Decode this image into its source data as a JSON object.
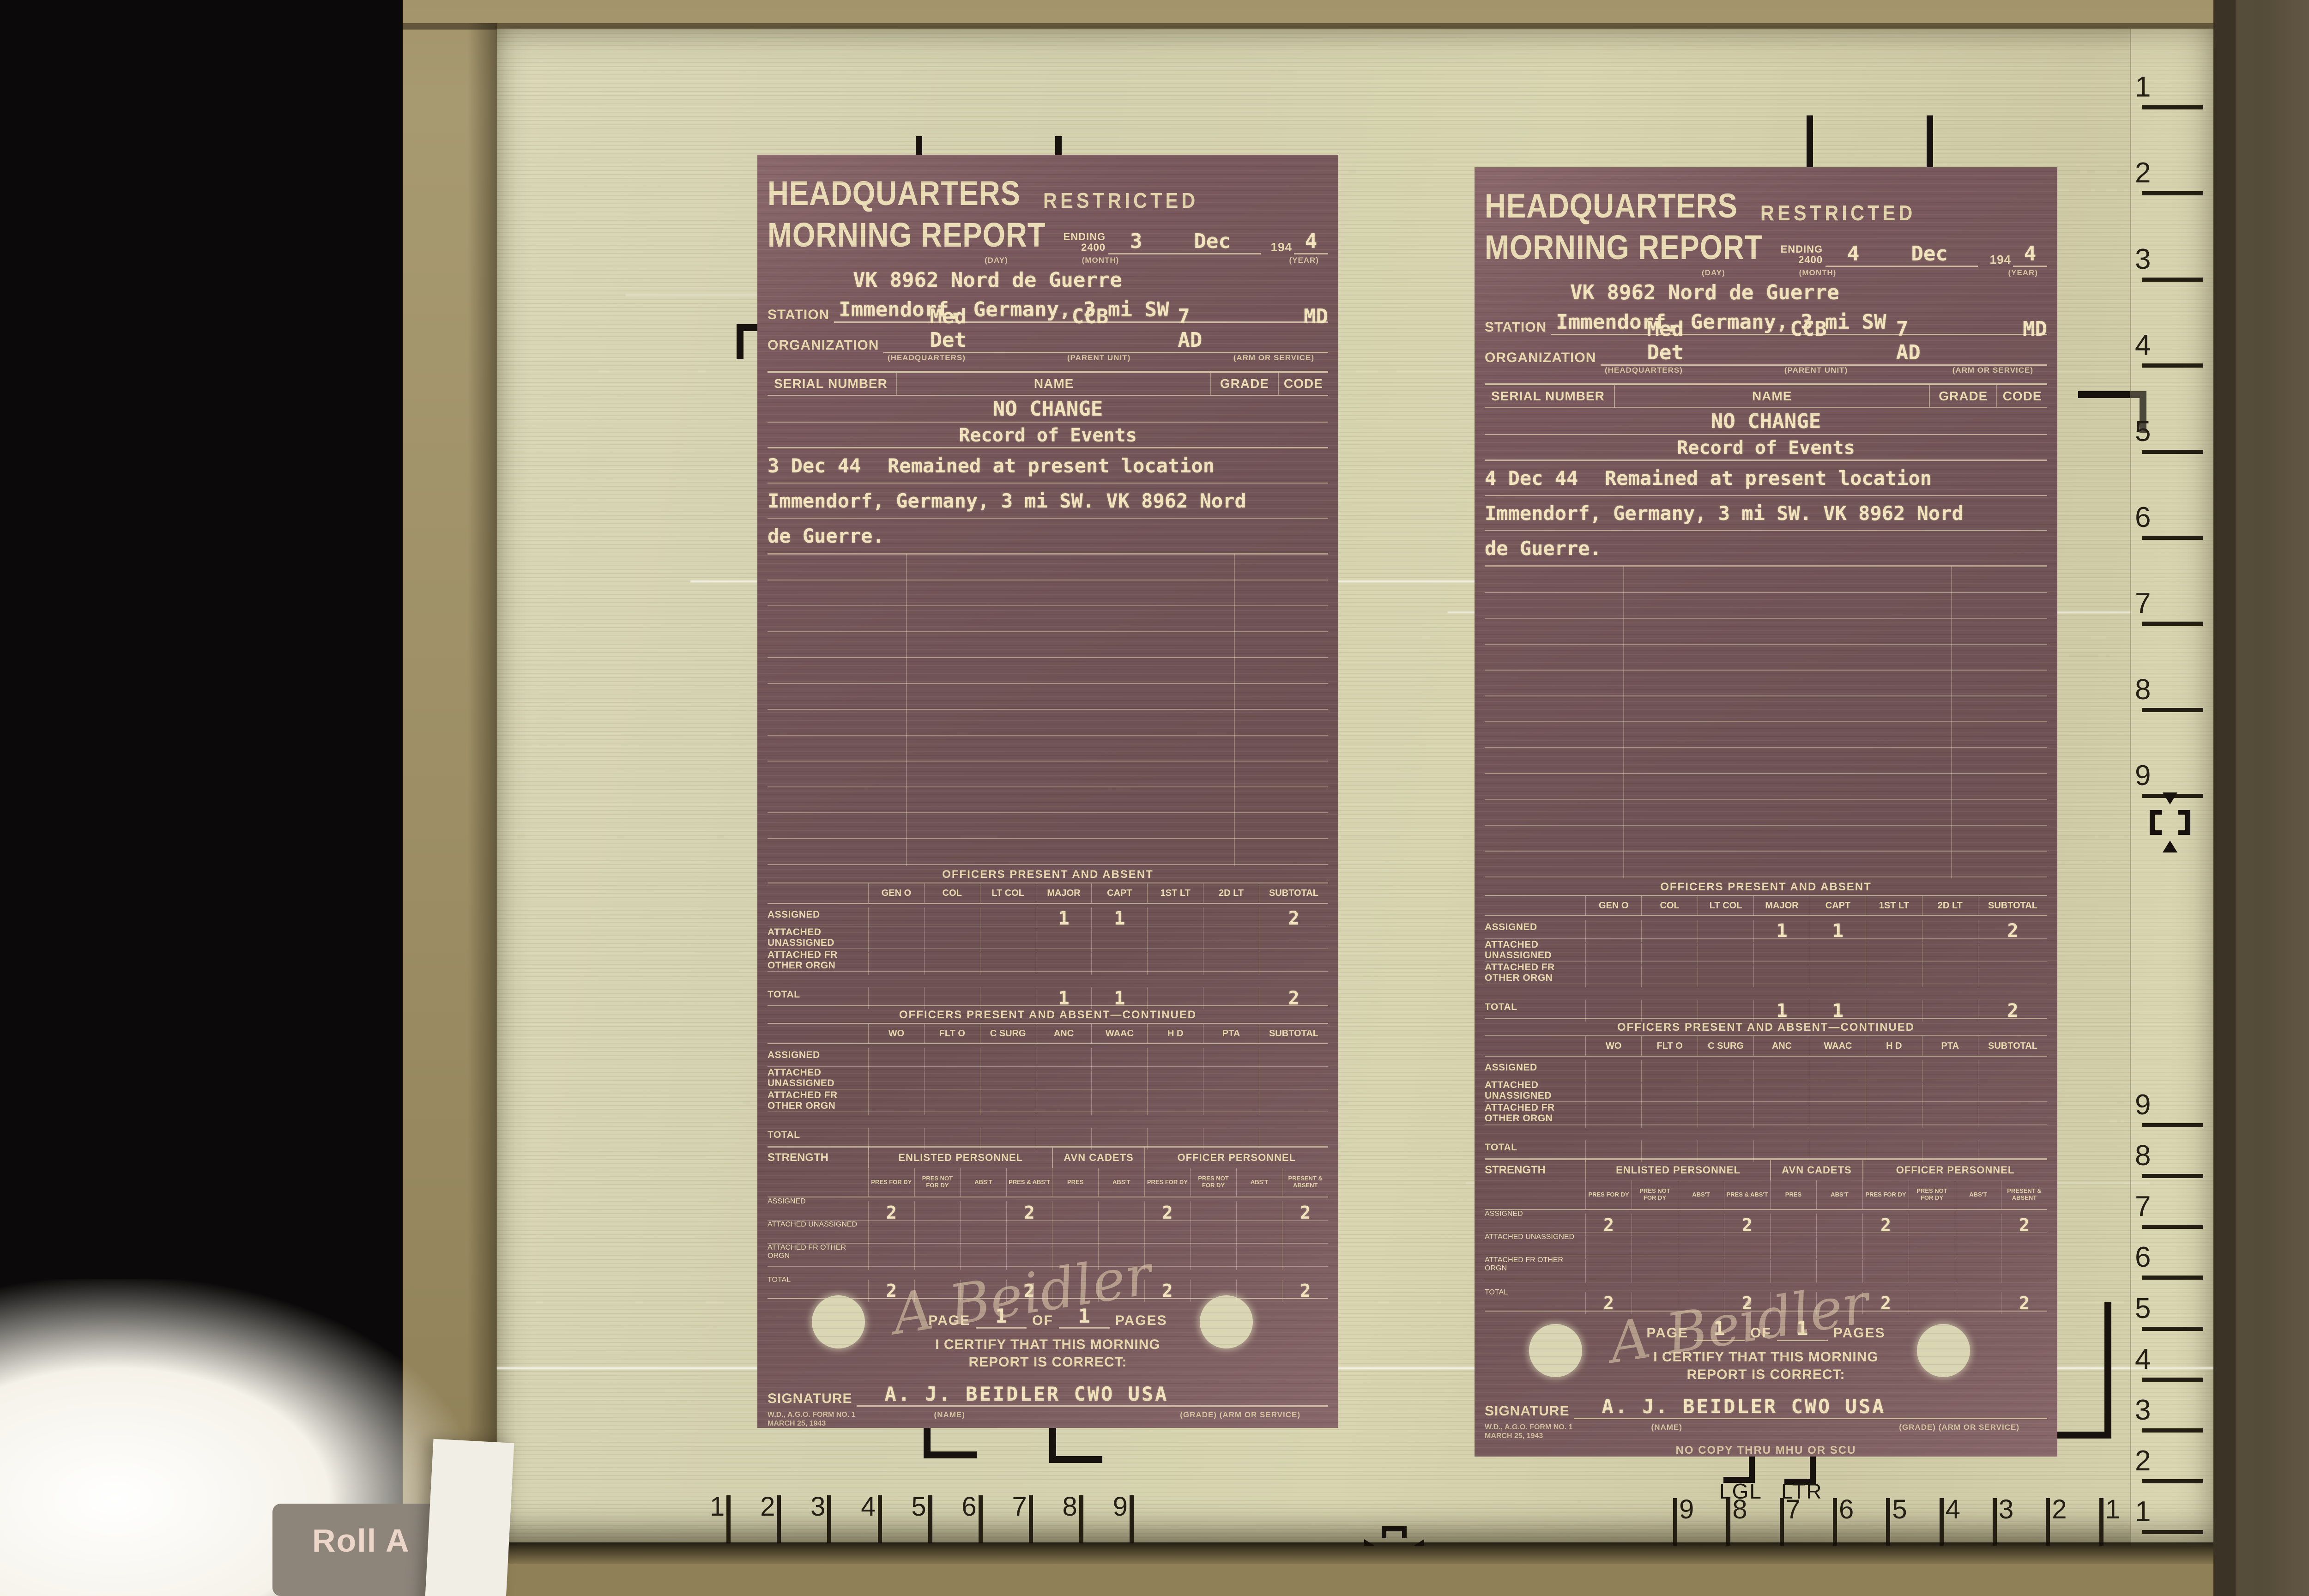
{
  "machine": {
    "roll_label": "Roll A",
    "lgl_label": "LGL",
    "ltr_label": "LTR"
  },
  "rulers": {
    "right_top": [
      "1",
      "2",
      "3",
      "4",
      "5",
      "6",
      "7",
      "8",
      "9"
    ],
    "right_bottom": [
      "9",
      "8",
      "7",
      "6",
      "5",
      "4",
      "3",
      "2",
      "1"
    ],
    "bottom_left": [
      "1",
      "2",
      "3",
      "4",
      "5",
      "6",
      "7",
      "8",
      "9"
    ],
    "bottom_right": [
      "9",
      "8",
      "7",
      "6",
      "5",
      "4",
      "3",
      "2",
      "1"
    ]
  },
  "documents": [
    {
      "header_line1": "HEADQUARTERS",
      "classification": "RESTRICTED",
      "header_line2": "MORNING REPORT",
      "ending_label_1": "ENDING",
      "ending_label_2": "2400",
      "day": "3",
      "month": "Dec",
      "year_prefix": "194",
      "year_digit": "4",
      "day_label": "(DAY)",
      "month_label": "(MONTH)",
      "year_label": "(YEAR)",
      "code_line": "VK 8962 Nord de Guerre",
      "station_label": "STATION",
      "station_value": "Immendorf, Germany, 3 mi SW",
      "organization_label": "ORGANIZATION",
      "org_headquarters": "Med Det",
      "org_parent1": "CCB",
      "org_parent2": "7 AD",
      "org_arm": "MD",
      "org_sub_headquarters": "(HEADQUARTERS)",
      "org_sub_parent": "(PARENT UNIT)",
      "org_sub_arm": "(ARM OR SERVICE)",
      "roster_headers": [
        "SERIAL NUMBER",
        "NAME",
        "GRADE",
        "CODE"
      ],
      "no_change": "NO CHANGE",
      "events_title": "Record of Events",
      "event_date": "3 Dec 44",
      "event_line1": "Remained at present location",
      "event_line2": "Immendorf, Germany, 3 mi SW. VK 8962 Nord",
      "event_line3": "de Guerre.",
      "officers": {
        "title": "OFFICERS PRESENT AND ABSENT",
        "columns": [
          "GEN O",
          "COL",
          "LT COL",
          "MAJOR",
          "CAPT",
          "1ST LT",
          "2D LT",
          "SUBTOTAL"
        ],
        "rows": [
          {
            "label": "ASSIGNED",
            "values": [
              "",
              "",
              "",
              "1",
              "1",
              "",
              "",
              "2"
            ]
          },
          {
            "label": "ATTACHED UNASSIGNED",
            "values": [
              "",
              "",
              "",
              "",
              "",
              "",
              "",
              ""
            ]
          },
          {
            "label": "ATTACHED FR OTHER ORGN",
            "values": [
              "",
              "",
              "",
              "",
              "",
              "",
              "",
              ""
            ]
          },
          {
            "label": "TOTAL",
            "values": [
              "",
              "",
              "",
              "1",
              "1",
              "",
              "",
              "2"
            ]
          }
        ]
      },
      "officers_continued": {
        "title": "OFFICERS PRESENT AND ABSENT—CONTINUED",
        "columns": [
          "WO",
          "FLT O",
          "C SURG",
          "ANC",
          "WAAC",
          "H D",
          "PTA",
          "SUBTOTAL"
        ],
        "rows": [
          {
            "label": "ASSIGNED",
            "values": [
              "",
              "",
              "",
              "",
              "",
              "",
              "",
              ""
            ]
          },
          {
            "label": "ATTACHED UNASSIGNED",
            "values": [
              "",
              "",
              "",
              "",
              "",
              "",
              "",
              ""
            ]
          },
          {
            "label": "ATTACHED FR OTHER ORGN",
            "values": [
              "",
              "",
              "",
              "",
              "",
              "",
              "",
              ""
            ]
          },
          {
            "label": "TOTAL",
            "values": [
              "",
              "",
              "",
              "",
              "",
              "",
              "",
              ""
            ]
          }
        ]
      },
      "strength": {
        "label": "STRENGTH",
        "group_headers": [
          "ENLISTED PERSONNEL",
          "AVN CADETS",
          "OFFICER PERSONNEL"
        ],
        "columns": [
          "PRES FOR DY",
          "PRES NOT FOR DY",
          "ABS'T",
          "PRES & ABS'T",
          "PRES",
          "ABS'T",
          "PRES FOR DY",
          "PRES NOT FOR DY",
          "ABS'T",
          "PRESENT & ABSENT"
        ],
        "rows": [
          {
            "label": "ASSIGNED",
            "values": [
              "2",
              "",
              "",
              "2",
              "",
              "",
              "2",
              "",
              "",
              "2"
            ]
          },
          {
            "label": "ATTACHED UNASSIGNED",
            "values": [
              "",
              "",
              "",
              "",
              "",
              "",
              "",
              "",
              "",
              ""
            ]
          },
          {
            "label": "ATTACHED FR OTHER ORGN",
            "values": [
              "",
              "",
              "",
              "",
              "",
              "",
              "",
              "",
              "",
              ""
            ]
          },
          {
            "label": "TOTAL",
            "values": [
              "2",
              "",
              "",
              "2",
              "",
              "",
              "2",
              "",
              "",
              "2"
            ]
          }
        ]
      },
      "page_label_1": "PAGE",
      "page_num": "1",
      "page_label_2": "OF",
      "page_total": "1",
      "page_label_3": "PAGES",
      "certify_line1": "I CERTIFY THAT THIS MORNING",
      "certify_line2": "REPORT IS CORRECT:",
      "signature_label": "SIGNATURE",
      "signature_text": "A. J. BEIDLER  CWO  USA",
      "signature_script": "A Beidler",
      "form_id_line1": "W.D., A.G.O. FORM NO. 1",
      "form_id_line2": "MARCH 25, 1943",
      "name_sublabel": "(NAME)",
      "grade_sublabel": "(GRADE)  (ARM OR SERVICE)",
      "copy_note": "NO COPY THRU MHU OR SCU"
    },
    {
      "header_line1": "HEADQUARTERS",
      "classification": "RESTRICTED",
      "header_line2": "MORNING REPORT",
      "ending_label_1": "ENDING",
      "ending_label_2": "2400",
      "day": "4",
      "month": "Dec",
      "year_prefix": "194",
      "year_digit": "4",
      "day_label": "(DAY)",
      "month_label": "(MONTH)",
      "year_label": "(YEAR)",
      "code_line": "VK 8962 Nord de Guerre",
      "station_label": "STATION",
      "station_value": "Immendorf, Germany, 3 mi SW",
      "organization_label": "ORGANIZATION",
      "org_headquarters": "Med Det",
      "org_parent1": "CCB",
      "org_parent2": "7 AD",
      "org_arm": "MD",
      "org_sub_headquarters": "(HEADQUARTERS)",
      "org_sub_parent": "(PARENT UNIT)",
      "org_sub_arm": "(ARM OR SERVICE)",
      "roster_headers": [
        "SERIAL NUMBER",
        "NAME",
        "GRADE",
        "CODE"
      ],
      "no_change": "NO CHANGE",
      "events_title": "Record of Events",
      "event_date": "4 Dec 44",
      "event_line1": "Remained at present location",
      "event_line2": "Immendorf, Germany, 3 mi SW. VK 8962 Nord",
      "event_line3": "de Guerre.",
      "officers": {
        "title": "OFFICERS PRESENT AND ABSENT",
        "columns": [
          "GEN O",
          "COL",
          "LT COL",
          "MAJOR",
          "CAPT",
          "1ST LT",
          "2D LT",
          "SUBTOTAL"
        ],
        "rows": [
          {
            "label": "ASSIGNED",
            "values": [
              "",
              "",
              "",
              "1",
              "1",
              "",
              "",
              "2"
            ]
          },
          {
            "label": "ATTACHED UNASSIGNED",
            "values": [
              "",
              "",
              "",
              "",
              "",
              "",
              "",
              ""
            ]
          },
          {
            "label": "ATTACHED FR OTHER ORGN",
            "values": [
              "",
              "",
              "",
              "",
              "",
              "",
              "",
              ""
            ]
          },
          {
            "label": "TOTAL",
            "values": [
              "",
              "",
              "",
              "1",
              "1",
              "",
              "",
              "2"
            ]
          }
        ]
      },
      "officers_continued": {
        "title": "OFFICERS PRESENT AND ABSENT—CONTINUED",
        "columns": [
          "WO",
          "FLT O",
          "C SURG",
          "ANC",
          "WAAC",
          "H D",
          "PTA",
          "SUBTOTAL"
        ],
        "rows": [
          {
            "label": "ASSIGNED",
            "values": [
              "",
              "",
              "",
              "",
              "",
              "",
              "",
              ""
            ]
          },
          {
            "label": "ATTACHED UNASSIGNED",
            "values": [
              "",
              "",
              "",
              "",
              "",
              "",
              "",
              ""
            ]
          },
          {
            "label": "ATTACHED FR OTHER ORGN",
            "values": [
              "",
              "",
              "",
              "",
              "",
              "",
              "",
              ""
            ]
          },
          {
            "label": "TOTAL",
            "values": [
              "",
              "",
              "",
              "",
              "",
              "",
              "",
              ""
            ]
          }
        ]
      },
      "strength": {
        "label": "STRENGTH",
        "group_headers": [
          "ENLISTED PERSONNEL",
          "AVN CADETS",
          "OFFICER PERSONNEL"
        ],
        "columns": [
          "PRES FOR DY",
          "PRES NOT FOR DY",
          "ABS'T",
          "PRES & ABS'T",
          "PRES",
          "ABS'T",
          "PRES FOR DY",
          "PRES NOT FOR DY",
          "ABS'T",
          "PRESENT & ABSENT"
        ],
        "rows": [
          {
            "label": "ASSIGNED",
            "values": [
              "2",
              "",
              "",
              "2",
              "",
              "",
              "2",
              "",
              "",
              "2"
            ]
          },
          {
            "label": "ATTACHED UNASSIGNED",
            "values": [
              "",
              "",
              "",
              "",
              "",
              "",
              "",
              "",
              "",
              ""
            ]
          },
          {
            "label": "ATTACHED FR OTHER ORGN",
            "values": [
              "",
              "",
              "",
              "",
              "",
              "",
              "",
              "",
              "",
              ""
            ]
          },
          {
            "label": "TOTAL",
            "values": [
              "2",
              "",
              "",
              "2",
              "",
              "",
              "2",
              "",
              "",
              "2"
            ]
          }
        ]
      },
      "page_label_1": "PAGE",
      "page_num": "1",
      "page_label_2": "OF",
      "page_total": "1",
      "page_label_3": "PAGES",
      "certify_line1": "I CERTIFY THAT THIS MORNING",
      "certify_line2": "REPORT IS CORRECT:",
      "signature_label": "SIGNATURE",
      "signature_text": "A. J. BEIDLER  CWO  USA",
      "signature_script": "A Beidler",
      "form_id_line1": "W.D., A.G.O. FORM NO. 1",
      "form_id_line2": "MARCH 25, 1943",
      "name_sublabel": "(NAME)",
      "grade_sublabel": "(GRADE)  (ARM OR SERVICE)",
      "copy_note": "NO COPY THRU MHU OR SCU"
    }
  ]
}
